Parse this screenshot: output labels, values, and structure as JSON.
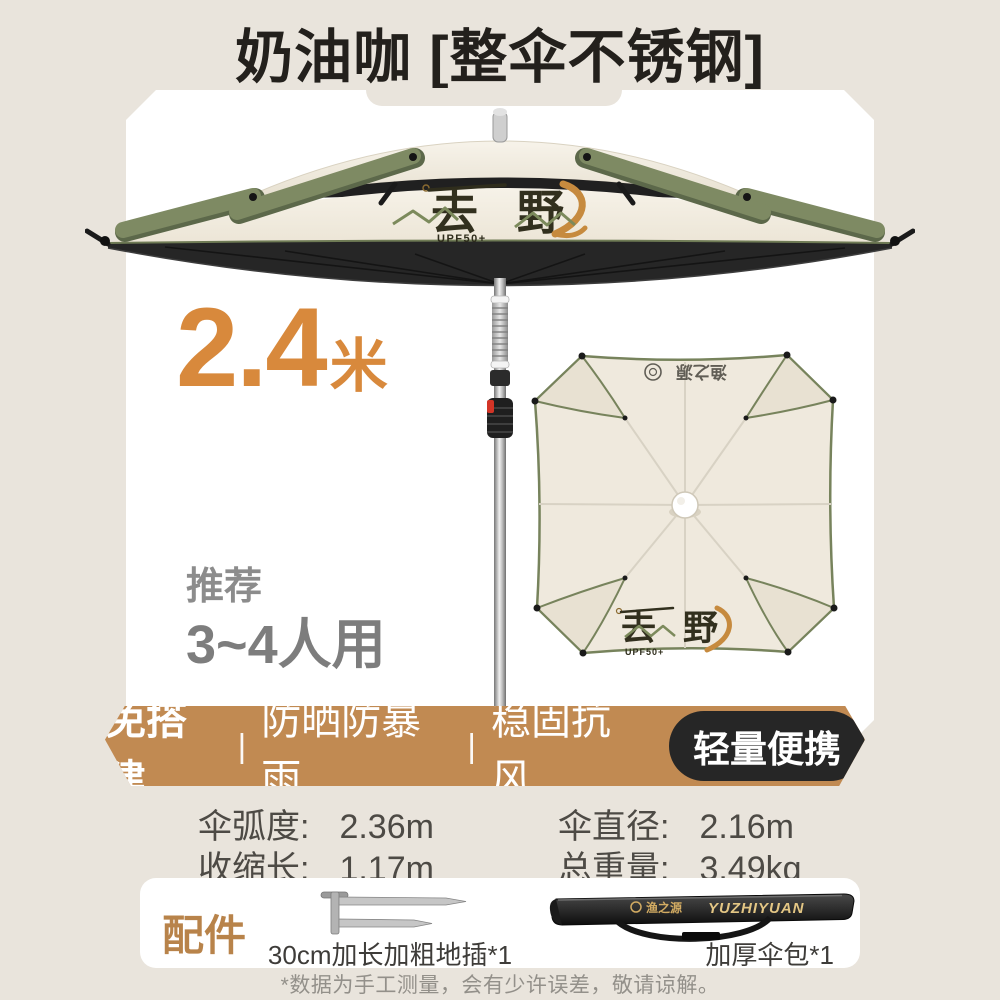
{
  "colors": {
    "page_bg": "#e9e4dc",
    "accent_orange": "#d8893c",
    "banner_tan": "#c18a52",
    "badge_black": "#262626",
    "sage_green": "#7e8a63",
    "canopy_cream": "#f0ebe0"
  },
  "header": {
    "title": "奶油咖 [整伞不锈钢]"
  },
  "hero": {
    "size_value": "2.4",
    "size_unit": "米",
    "recommend_label": "推荐",
    "recommend_value": "3~4人用",
    "canopy_logo": {
      "left": "去",
      "right": "野",
      "sub": "UPF50+"
    },
    "topview": {
      "brand": "渔之源",
      "logo_left": "去",
      "logo_right": "野",
      "logo_sub": "UPF50+"
    }
  },
  "banner": {
    "features": [
      "免搭建",
      "防晒防暴雨",
      "稳固抗风"
    ],
    "separator": "|",
    "badge": "轻量便携"
  },
  "specs": {
    "rows": [
      {
        "label": "伞弧度:",
        "value": "2.36m"
      },
      {
        "label": "伞直径:",
        "value": "2.16m"
      },
      {
        "label": "收缩长:",
        "value": "1.17m"
      },
      {
        "label": "总重量:",
        "value": "3.49kg"
      }
    ]
  },
  "accessories": {
    "title": "配件",
    "stake_label": "30cm加长加粗地插*1",
    "bag_label": "加厚伞包*1",
    "bag_brand_cn": "渔之源",
    "bag_brand_en": "YUZHIYUAN"
  },
  "footnote": "*数据为手工测量，会有少许误差，敬请谅解。"
}
